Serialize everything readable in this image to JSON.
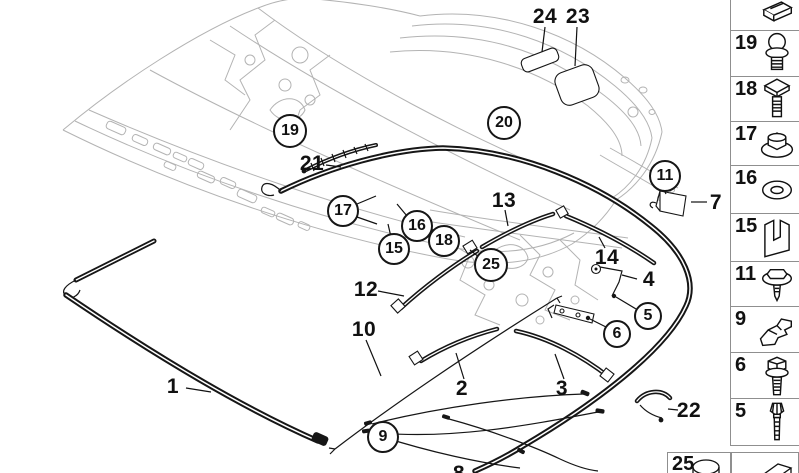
{
  "colors": {
    "background": "#ffffff",
    "line": "#161616",
    "frame": "#b3b3b3",
    "border": "#8f8f8f"
  },
  "callouts": [
    {
      "label": "24",
      "circled": false,
      "x": 545,
      "y": 17
    },
    {
      "label": "23",
      "circled": false,
      "x": 578,
      "y": 17
    },
    {
      "label": "19",
      "circled": true,
      "x": 290,
      "y": 131,
      "r": 16
    },
    {
      "label": "21",
      "circled": false,
      "x": 312,
      "y": 164
    },
    {
      "label": "20",
      "circled": true,
      "x": 504,
      "y": 123,
      "r": 16
    },
    {
      "label": "11",
      "circled": true,
      "x": 665,
      "y": 176,
      "r": 15
    },
    {
      "label": "7",
      "circled": false,
      "x": 716,
      "y": 203
    },
    {
      "label": "17",
      "circled": true,
      "x": 343,
      "y": 211,
      "r": 15
    },
    {
      "label": "16",
      "circled": true,
      "x": 417,
      "y": 226,
      "r": 15
    },
    {
      "label": "15",
      "circled": true,
      "x": 394,
      "y": 249,
      "r": 15
    },
    {
      "label": "18",
      "circled": true,
      "x": 444,
      "y": 241,
      "r": 15
    },
    {
      "label": "13",
      "circled": false,
      "x": 504,
      "y": 201
    },
    {
      "label": "25",
      "circled": true,
      "x": 491,
      "y": 265,
      "r": 16
    },
    {
      "label": "14",
      "circled": false,
      "x": 607,
      "y": 258
    },
    {
      "label": "12",
      "circled": false,
      "x": 366,
      "y": 290
    },
    {
      "label": "4",
      "circled": false,
      "x": 649,
      "y": 280
    },
    {
      "label": "5",
      "circled": true,
      "x": 648,
      "y": 316,
      "r": 13
    },
    {
      "label": "6",
      "circled": true,
      "x": 617,
      "y": 334,
      "r": 13
    },
    {
      "label": "10",
      "circled": false,
      "x": 364,
      "y": 330
    },
    {
      "label": "1",
      "circled": false,
      "x": 173,
      "y": 387
    },
    {
      "label": "2",
      "circled": false,
      "x": 462,
      "y": 389
    },
    {
      "label": "3",
      "circled": false,
      "x": 562,
      "y": 389
    },
    {
      "label": "9",
      "circled": true,
      "x": 383,
      "y": 437,
      "r": 15
    },
    {
      "label": "22",
      "circled": false,
      "x": 689,
      "y": 411
    },
    {
      "label": "8",
      "circled": false,
      "x": 459,
      "y": 474
    }
  ],
  "sidebar": {
    "cells": [
      {
        "label": "",
        "icon": "retainer-clip"
      },
      {
        "label": "19",
        "icon": "ball-stud"
      },
      {
        "label": "18",
        "icon": "square-head-bolt"
      },
      {
        "label": "17",
        "icon": "flange-nut"
      },
      {
        "label": "16",
        "icon": "washer"
      },
      {
        "label": "15",
        "icon": "c-clip"
      },
      {
        "label": "11",
        "icon": "washer-screw"
      },
      {
        "label": "9",
        "icon": "z-bracket"
      },
      {
        "label": "6",
        "icon": "hex-bolt"
      },
      {
        "label": "5",
        "icon": "expanding-rivet"
      }
    ],
    "bottom_cells": [
      {
        "label": "25",
        "icon": "cap-cylinder"
      },
      {
        "label": "",
        "icon": "v-clip"
      }
    ]
  }
}
